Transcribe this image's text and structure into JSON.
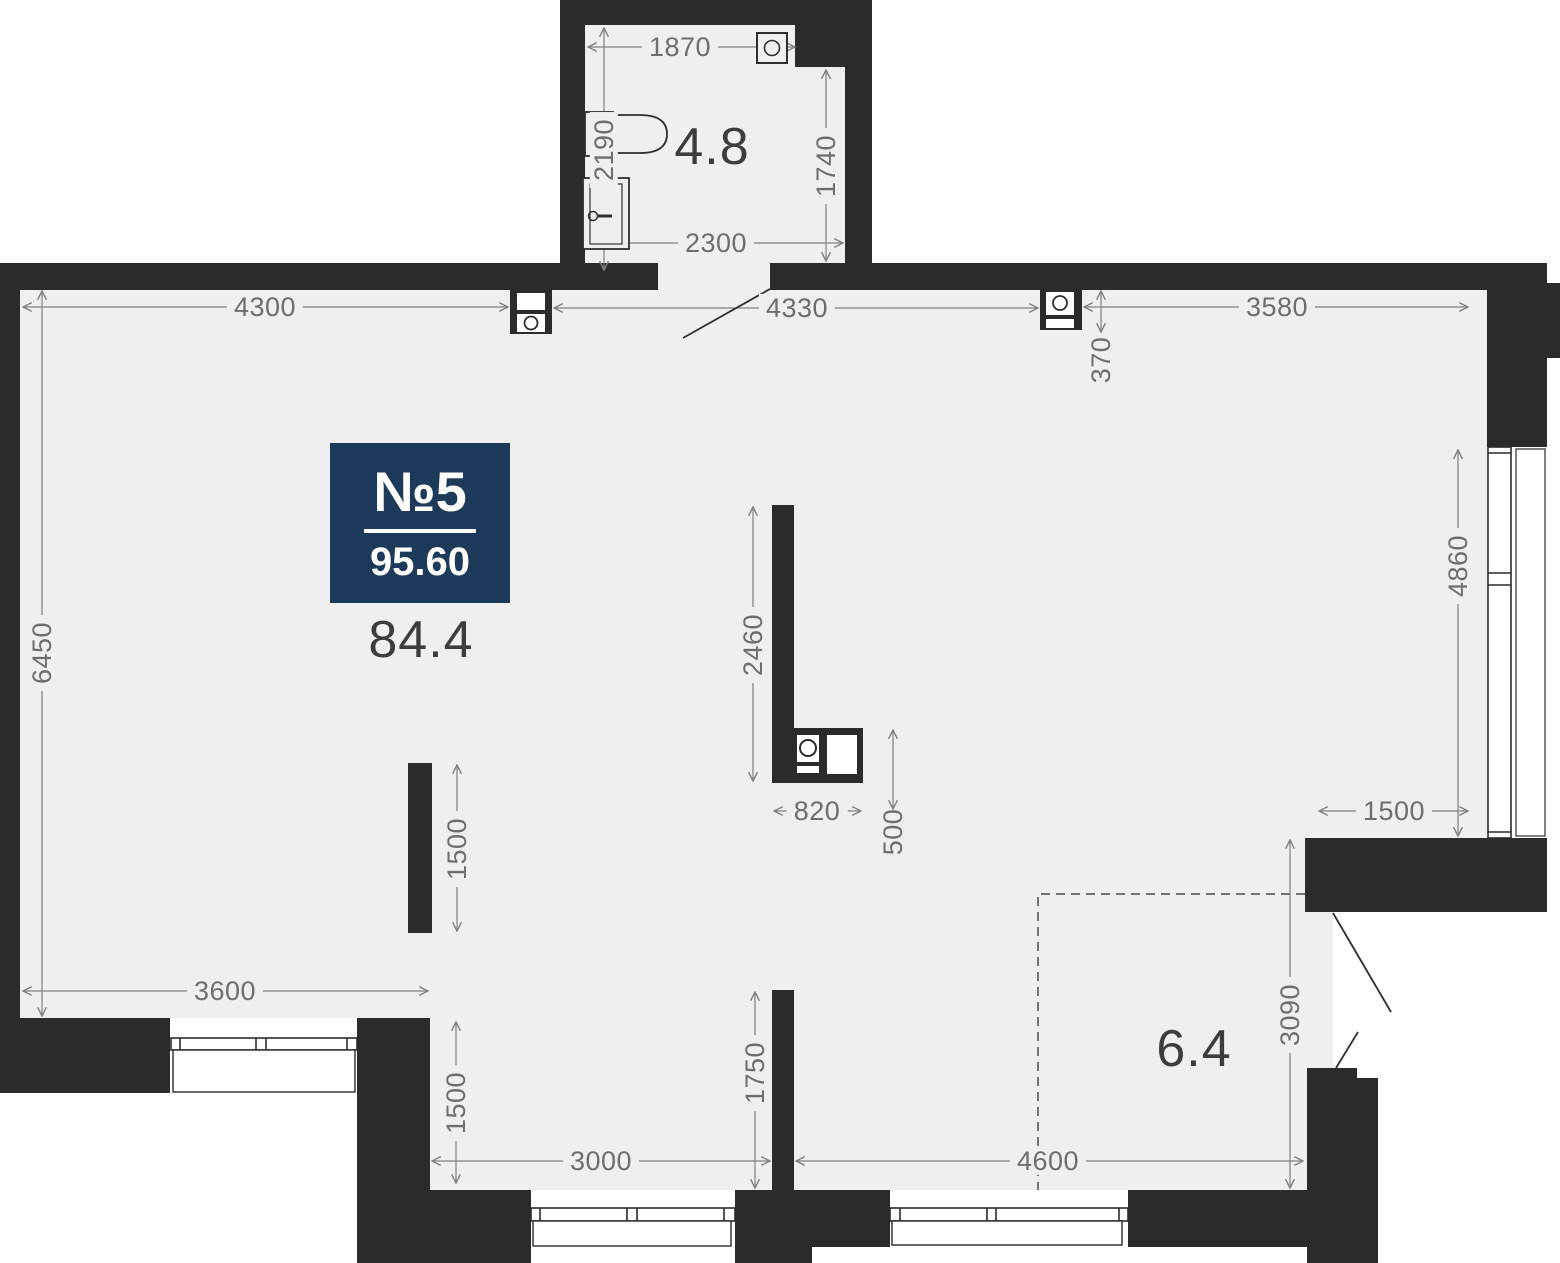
{
  "unit": {
    "number_label": "№5",
    "total_area": "95.60",
    "main_area": "84.4"
  },
  "rooms": {
    "bathroom_area": "4.8",
    "balcony_area": "6.4"
  },
  "dimensions": {
    "bath_top_width": "1870",
    "bath_left_depth": "2190",
    "bath_right_depth": "1740",
    "bath_bottom_width": "2300",
    "top_wall_left": "4300",
    "top_wall_mid": "4330",
    "vent_offset": "370",
    "top_wall_right": "3580",
    "left_wall": "6450",
    "right_window": "4860",
    "kitchen_partition": "2460",
    "kitchen_block_width": "820",
    "kitchen_block_depth": "500",
    "mid_wall_stub": "1500",
    "bottom_left_wall": "3600",
    "bottom_left_recess": "1500",
    "bottom_mid_wall": "3000",
    "bottom_partition": "1750",
    "balcony_width": "4600",
    "balcony_depth": "3090",
    "right_recess": "1500"
  },
  "icons": {
    "ventilation": "square-with-circle",
    "toilet": "toilet-outline",
    "sink": "sink-outline",
    "washing_machine": "square-with-circle"
  },
  "colors": {
    "wall": "#2b2b2b",
    "floor": "#efefef",
    "outside": "#ffffff",
    "badge": "#1d3a5b",
    "dimension": "#6e6e6e",
    "area_text": "#3d3d3d"
  }
}
